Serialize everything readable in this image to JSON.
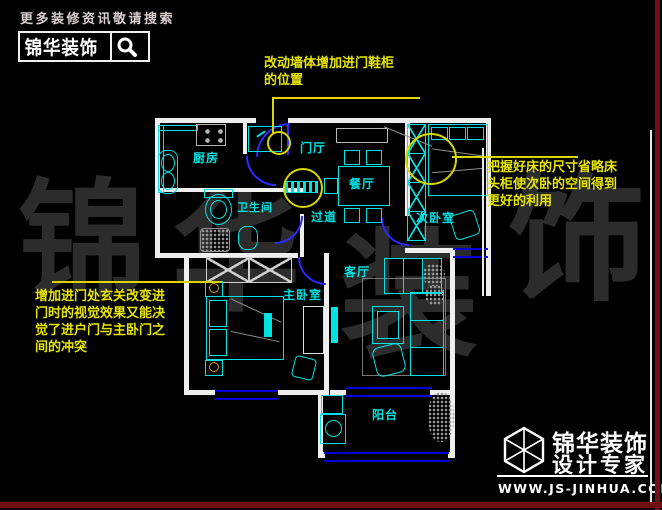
{
  "header": {
    "tagline": "更多装修资讯敬请搜索",
    "brand": "锦华装饰",
    "icon": "magnifier-icon"
  },
  "watermark": {
    "chars": [
      "锦",
      "华",
      "装",
      "饰"
    ]
  },
  "plan": {
    "rooms": [
      {
        "label": "厨房"
      },
      {
        "label": "门厅"
      },
      {
        "label": "餐厅"
      },
      {
        "label": "卫生间"
      },
      {
        "label": "过道"
      },
      {
        "label": "次卧室"
      },
      {
        "label": "客厅"
      },
      {
        "label": "主卧室"
      },
      {
        "label": "阳台"
      }
    ]
  },
  "annotations": {
    "top": {
      "lines": [
        "改动墙体增加进门鞋柜",
        "的位置"
      ]
    },
    "right": {
      "lines": [
        "把握好床的尺寸省略床",
        "头柜使次卧的空间得到",
        "更好的利用"
      ]
    },
    "left": {
      "lines": [
        "增加进门处玄关改变进",
        "门时的视觉效果又能决",
        "觉了进户门与主卧门之",
        "间的冲突"
      ]
    }
  },
  "footer": {
    "brand_line1": "锦华装饰",
    "brand_line2": "设计专家",
    "website": "WWW.JS-JINHUA.COM",
    "icon": "cube-logo-icon"
  },
  "colors": {
    "background": "#000000",
    "walls": "#efefef",
    "furniture": "#00e1e1",
    "doors": "#2a2aff",
    "windows": "#0000d8",
    "annotation_yellow": "#e6e600",
    "watermark_gray": "#2c2c2c",
    "frame_maroon": "#701016"
  }
}
